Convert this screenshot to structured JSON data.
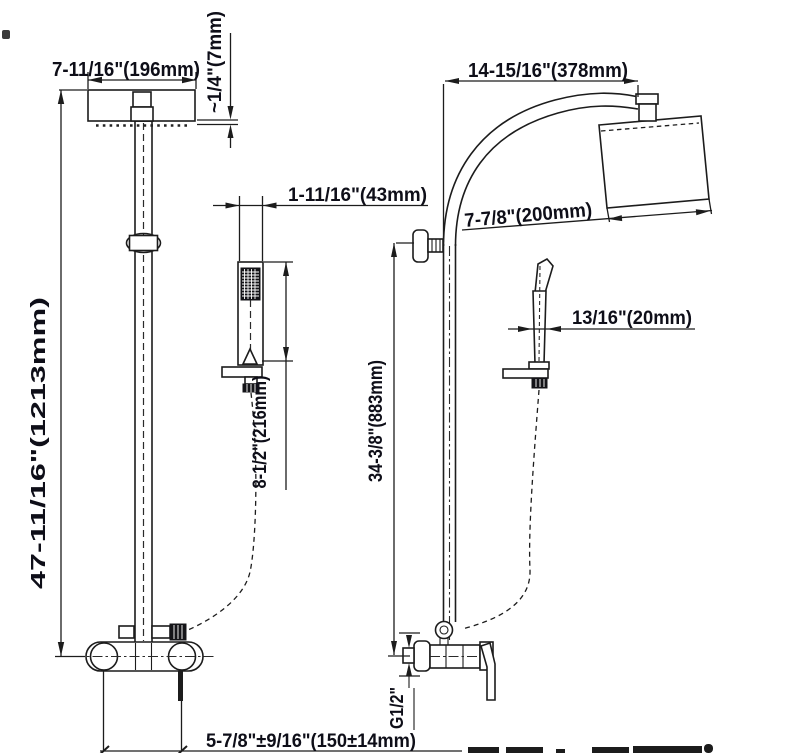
{
  "drawing": {
    "type": "shower-system-dimension-diagram",
    "colors": {
      "line": "#1c1c1c",
      "text": "#0e0e18",
      "background": "#ffffff"
    },
    "dims": {
      "head_width": "7-11/16\"(196mm)",
      "head_thickness": "~1/4\"(7mm)",
      "total_height": "47-11/16\"(1213mm)",
      "handshower_width": "1-11/16\"(43mm)",
      "handshower_length": "8-1/2\"(216mm)",
      "inlet_spacing": "5-7/8\"±9/16\"(150±14mm)",
      "arm_reach": "14-15/16\"(378mm)",
      "head_depth": "7-7/8\"(200mm)",
      "wand_thickness": "13/16\"(20mm)",
      "bracket_height": "34-3/8\"(883mm)",
      "inlet_thread": "G1/2\""
    }
  }
}
